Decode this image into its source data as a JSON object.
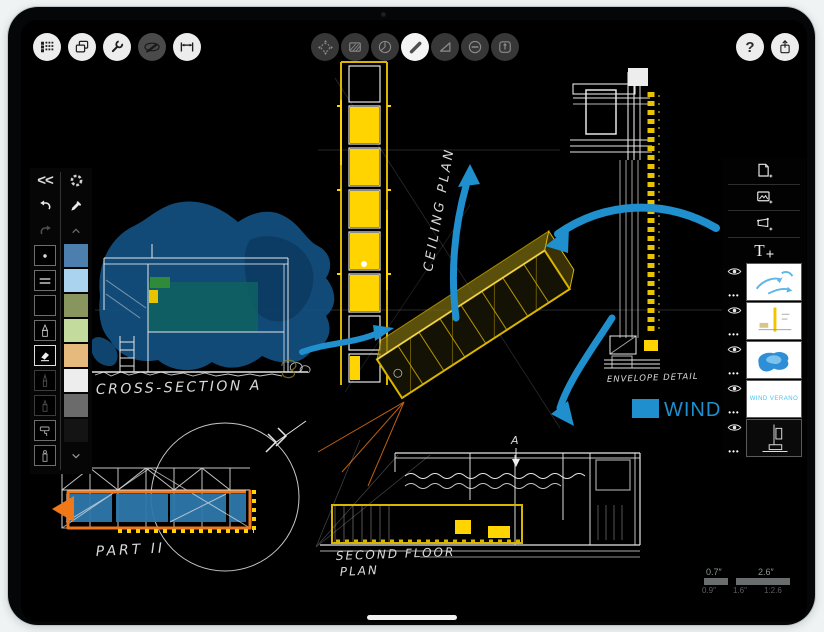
{
  "device": {
    "type": "tablet",
    "home_indicator": true
  },
  "header": {
    "left_buttons": [
      {
        "name": "projects",
        "icon": "menu-grid-icon"
      },
      {
        "name": "pages",
        "icon": "pages-icon"
      },
      {
        "name": "settings",
        "icon": "wrench-icon"
      },
      {
        "name": "stylus",
        "icon": "stylus-icon",
        "state": "inactive"
      },
      {
        "name": "measure",
        "icon": "measure-icon"
      }
    ],
    "center_buttons": [
      {
        "name": "transform",
        "icon": "move-icon"
      },
      {
        "name": "fill",
        "icon": "hatch-icon"
      },
      {
        "name": "protractor",
        "icon": "protractor-icon"
      },
      {
        "name": "draw",
        "icon": "pen-stroke-icon",
        "state": "selected"
      },
      {
        "name": "ruler",
        "icon": "triangle-icon"
      },
      {
        "name": "erase",
        "icon": "eraser-circle-icon"
      },
      {
        "name": "stamp",
        "icon": "stamp-icon"
      }
    ],
    "help_glyph": "?",
    "right_buttons": [
      {
        "name": "help",
        "icon": "help-icon"
      },
      {
        "name": "share",
        "icon": "share-icon"
      }
    ]
  },
  "tool_palette": {
    "collapse_glyph": "<<",
    "tools": [
      {
        "name": "dot-brush"
      },
      {
        "name": "double-line"
      },
      {
        "name": "solid-brush"
      },
      {
        "name": "technical-pen"
      },
      {
        "name": "eraser",
        "state": "selected"
      },
      {
        "name": "pencil",
        "state": "dim"
      },
      {
        "name": "fine-liner",
        "state": "dim"
      },
      {
        "name": "paint-roller"
      },
      {
        "name": "airbrush-marker"
      }
    ],
    "swatches": [
      "#4d7fae",
      "#a9d3ee",
      "#88955e",
      "#c3dc9d",
      "#e5ba7c",
      "#ededed",
      "#6b6b6b",
      "#141414"
    ]
  },
  "layers_panel": {
    "add_buttons": [
      "add-page-icon",
      "add-image-icon",
      "add-frame-icon",
      "add-text-icon"
    ],
    "add_text_glyph": "T",
    "ellipsis_glyph": "•••",
    "layers": [
      {
        "name": "blue-arrow-annotations",
        "visible": true
      },
      {
        "name": "ceiling-plan-sketch",
        "visible": true
      },
      {
        "name": "blue-massing",
        "visible": true
      },
      {
        "name": "wind-text",
        "visible": true,
        "thumb_text": "WIND VERANO"
      },
      {
        "name": "base-line-drawing",
        "visible": true
      }
    ]
  },
  "canvas": {
    "labels": {
      "ceiling_plan": "CEILING PLAN",
      "cross_section": "CROSS-SECTION A",
      "envelope_detail": "ENVELOPE DETAIL",
      "wind_text": "WIND VE",
      "second_floor_line1": "SECOND FLOOR",
      "second_floor_line2": "PLAN",
      "part_two": "PART II",
      "section_marker": "A"
    },
    "scale_bar": {
      "label_small": "0.7″",
      "label_large": "2.6″",
      "sub_left": "0.9″",
      "sub_mid": "1.6″",
      "sub_right": "1:2.6"
    },
    "colors": {
      "arrow_blue": "#1f8fce",
      "sketch_yellow": "#d9b500",
      "highlight_yellow": "#ffd400",
      "accent_orange": "#f07818",
      "massing_blue": "#125081",
      "panel_blue": "#2e78ab",
      "teal_fill": "#0f5f63"
    }
  }
}
